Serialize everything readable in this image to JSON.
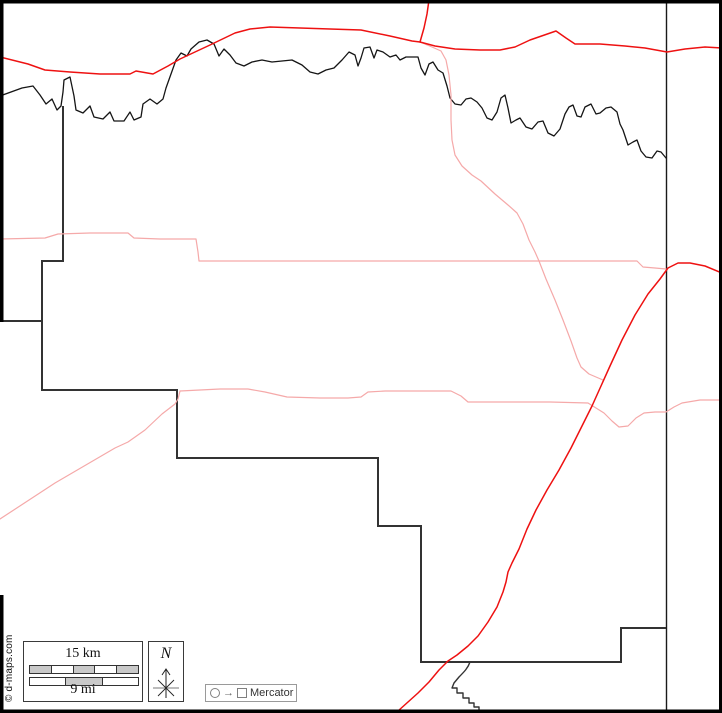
{
  "map": {
    "attribution": "© d-maps.com",
    "scale": {
      "km_label": "15 km",
      "mi_label": "9 mi"
    },
    "north_label": "N",
    "projection": {
      "label": "Mercator"
    },
    "colors": {
      "border": "#000000",
      "boundary": "#333333",
      "divider": "#1a1a1a",
      "river": "#151515",
      "road_primary": "#ee1111",
      "road_secondary": "#f5a9a9",
      "scale_fill": "#c9c9c9"
    }
  }
}
